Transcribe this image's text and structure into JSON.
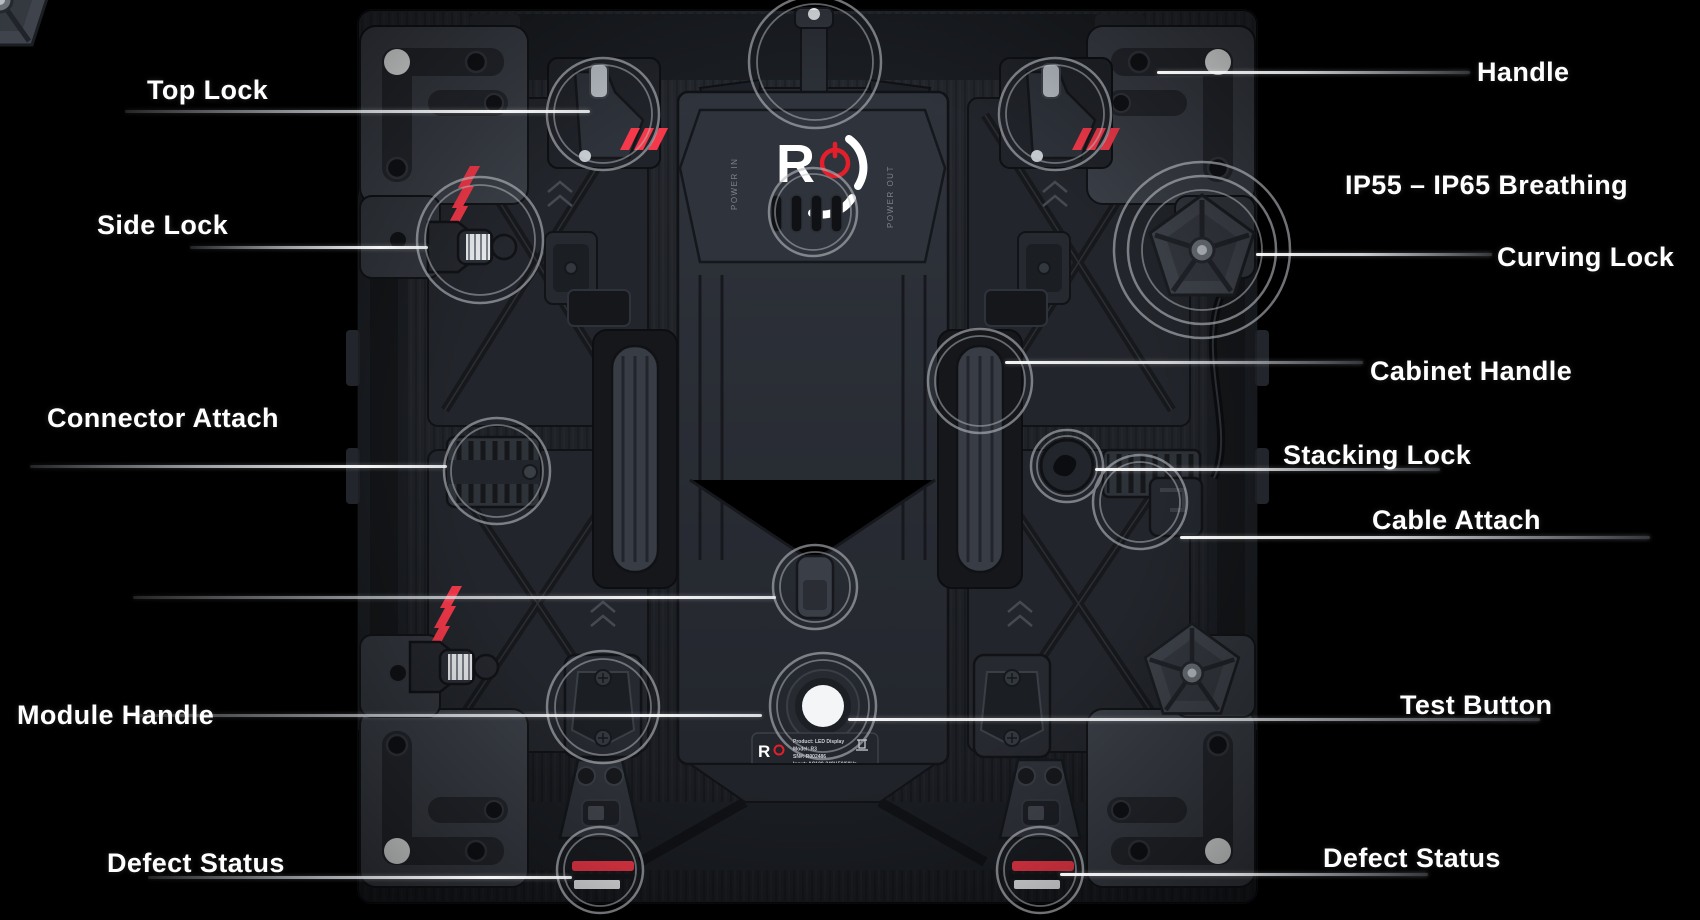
{
  "colors": {
    "background": "#000000",
    "label_text": "#ffffff",
    "accent_red": "#f5394a",
    "ring_gray": "#b9bdc3"
  },
  "callouts": [
    {
      "id": "top-lock",
      "label": "Top Lock",
      "side": "left"
    },
    {
      "id": "side-lock",
      "label": "Side Lock",
      "side": "left"
    },
    {
      "id": "connector-attach",
      "label": "Connector Attach",
      "side": "left"
    },
    {
      "id": "module-handle",
      "label": "Module Handle",
      "side": "left"
    },
    {
      "id": "defect-status-left",
      "label": "Defect Status",
      "side": "left"
    },
    {
      "id": "handle",
      "label": "Handle",
      "side": "right"
    },
    {
      "id": "ip-breathing",
      "label": "IP55 – IP65 Breathing",
      "side": "right"
    },
    {
      "id": "curving-lock",
      "label": "Curving Lock",
      "side": "right"
    },
    {
      "id": "cabinet-handle",
      "label": "Cabinet Handle",
      "side": "right"
    },
    {
      "id": "stacking-lock",
      "label": "Stacking Lock",
      "side": "right"
    },
    {
      "id": "cable-attach",
      "label": "Cable Attach",
      "side": "right"
    },
    {
      "id": "test-button",
      "label": "Test Button",
      "side": "right"
    },
    {
      "id": "defect-status-right",
      "label": "Defect Status",
      "side": "right"
    }
  ],
  "device": {
    "logo": {
      "letter": "R",
      "power_icon": "power-symbol"
    },
    "side_markings": {
      "left": "POWER IN",
      "right": "POWER OUT"
    },
    "label_plate": {
      "info_lines": [
        "Product: LED Display",
        "Model: R3",
        "SN#: R002486",
        "Input: AC100-240V,50/60Hz"
      ],
      "spec_lines": [
        "Input Current:15A MAX",
        "Output: AC100-240V,50/60Hz",
        "Output Current:13.5A MAX"
      ],
      "cert_marks": [
        "FCC",
        "CE"
      ]
    }
  }
}
